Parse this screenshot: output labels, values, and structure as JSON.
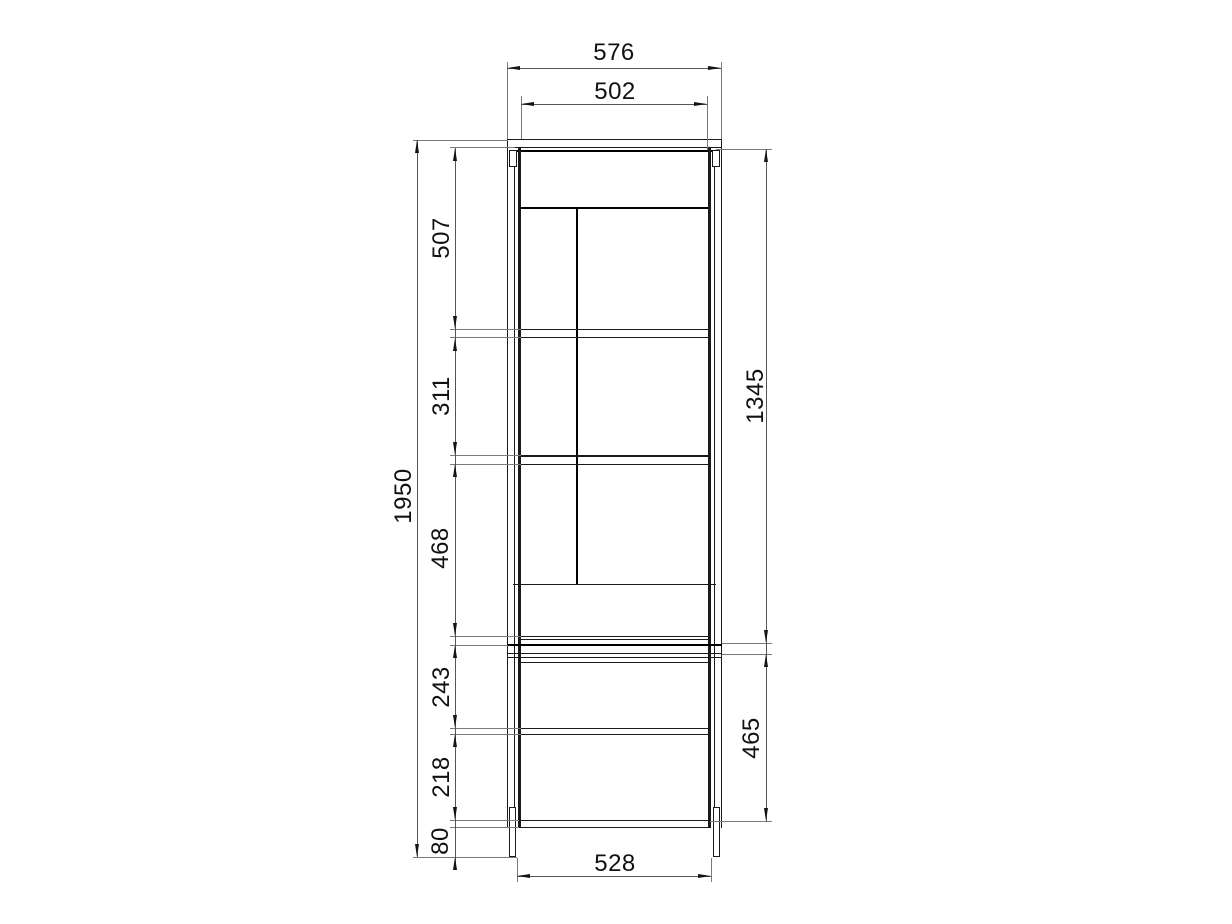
{
  "colors": {
    "background": "#ffffff",
    "object_line": "#1a1a1a",
    "dimension_line": "#555555",
    "extension_line": "#7a7a7a",
    "text": "#111111"
  },
  "dimensions": {
    "top_outer_width": "576",
    "top_inner_width": "502",
    "overall_height": "1950",
    "upper_compartment_1": "507",
    "upper_compartment_2": "311",
    "upper_compartment_3": "468",
    "upper_section_height": "1345",
    "lower_compartment_1": "243",
    "lower_compartment_2": "218",
    "plinth_height": "80",
    "lower_section_height": "465",
    "bottom_board_width": "528"
  }
}
